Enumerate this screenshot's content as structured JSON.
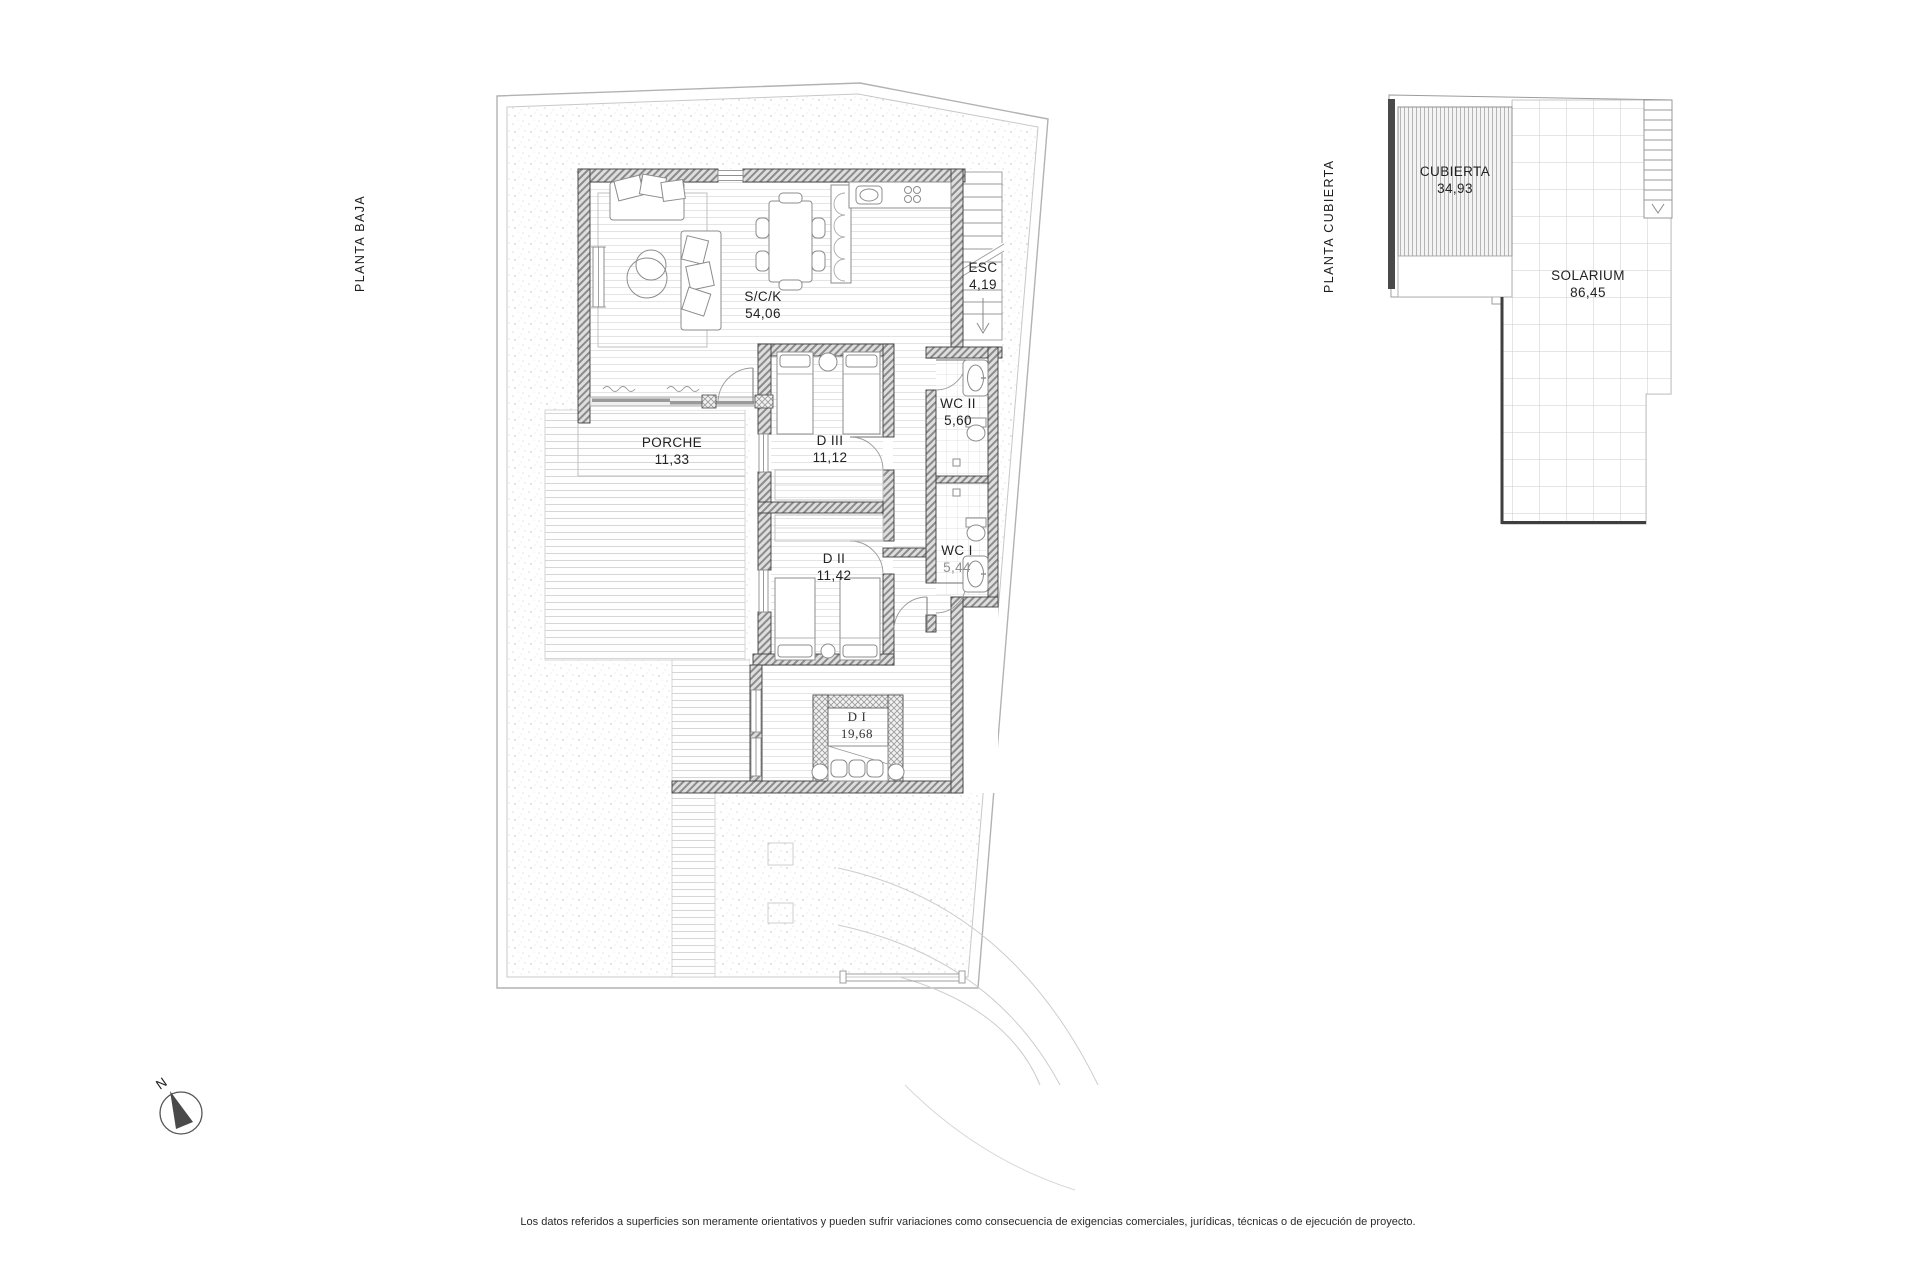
{
  "titles": {
    "ground": "PLANTA BAJA",
    "roof": "PLANTA CUBIERTA"
  },
  "ground_floor": {
    "rooms": [
      {
        "id": "sck",
        "name": "S/C/K",
        "area": "54,06"
      },
      {
        "id": "esc",
        "name": "ESC",
        "area": "4,19"
      },
      {
        "id": "wc2",
        "name": "WC II",
        "area": "5,60"
      },
      {
        "id": "d3",
        "name": "D III",
        "area": "11,12"
      },
      {
        "id": "porche",
        "name": "PORCHE",
        "area": "11,33"
      },
      {
        "id": "d2",
        "name": "D II",
        "area": "11,42"
      },
      {
        "id": "wc1",
        "name": "WC I",
        "area": "5,44"
      },
      {
        "id": "d1",
        "name": "D I",
        "area": "19,68"
      }
    ]
  },
  "roof_plan": {
    "rooms": [
      {
        "id": "cubierta",
        "name": "CUBIERTA",
        "area": "34,93"
      },
      {
        "id": "solarium",
        "name": "SOLARIUM",
        "area": "86,45"
      }
    ]
  },
  "compass": {
    "north": "N"
  },
  "footer": {
    "disclaimer": "Los datos referidos a superficies son meramente orientativos y pueden sufrir variaciones como consecuencia de exigencias comerciales, jurídicas, técnicas o de ejecución de proyecto."
  }
}
